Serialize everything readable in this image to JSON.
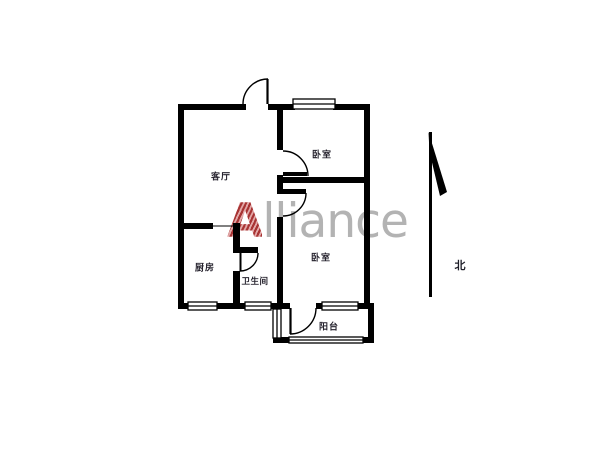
{
  "watermark": {
    "text_accent": "A",
    "text_rest": "lliance",
    "accent_color": "#a83434",
    "gray_color": "#b3b3b3"
  },
  "compass": {
    "label": "北"
  },
  "rooms": {
    "living": {
      "label": "客厅"
    },
    "bedroom1": {
      "label": "卧室"
    },
    "bedroom2": {
      "label": "卧室"
    },
    "kitchen": {
      "label": "厨房"
    },
    "bathroom": {
      "label": "卫生间"
    },
    "balcony": {
      "label": "阳台"
    }
  },
  "colors": {
    "wall": "#000000",
    "background": "#ffffff",
    "label_text": "#26232e"
  }
}
